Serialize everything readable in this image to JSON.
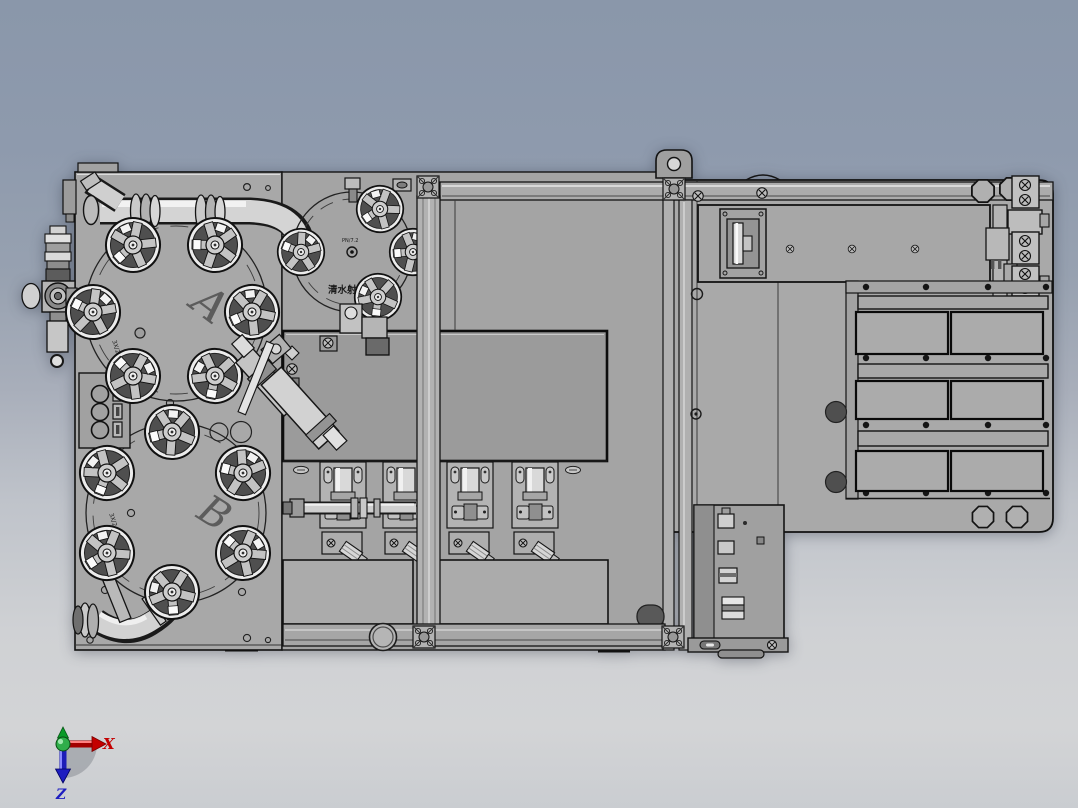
{
  "scene": {
    "type": "cad-3d-viewport-top-view",
    "background_top": "#8e9aad",
    "background_bottom": "#d2d3d5",
    "machine_gray": "#a8a8a8",
    "outline_color": "#141414"
  },
  "labels": {
    "circle_a": "A",
    "circle_b": "B"
  },
  "engravings": {
    "circle_a_mark": "3X/2.4",
    "circle_b_mark": "3X/2.4",
    "dial_small": "PN/7.2",
    "dial_bold": "清水射流"
  },
  "triad": {
    "x": "X",
    "z": "Z",
    "x_color": "#c40000",
    "z_color": "#1d1dc0",
    "y_color": "#0a9a28"
  }
}
